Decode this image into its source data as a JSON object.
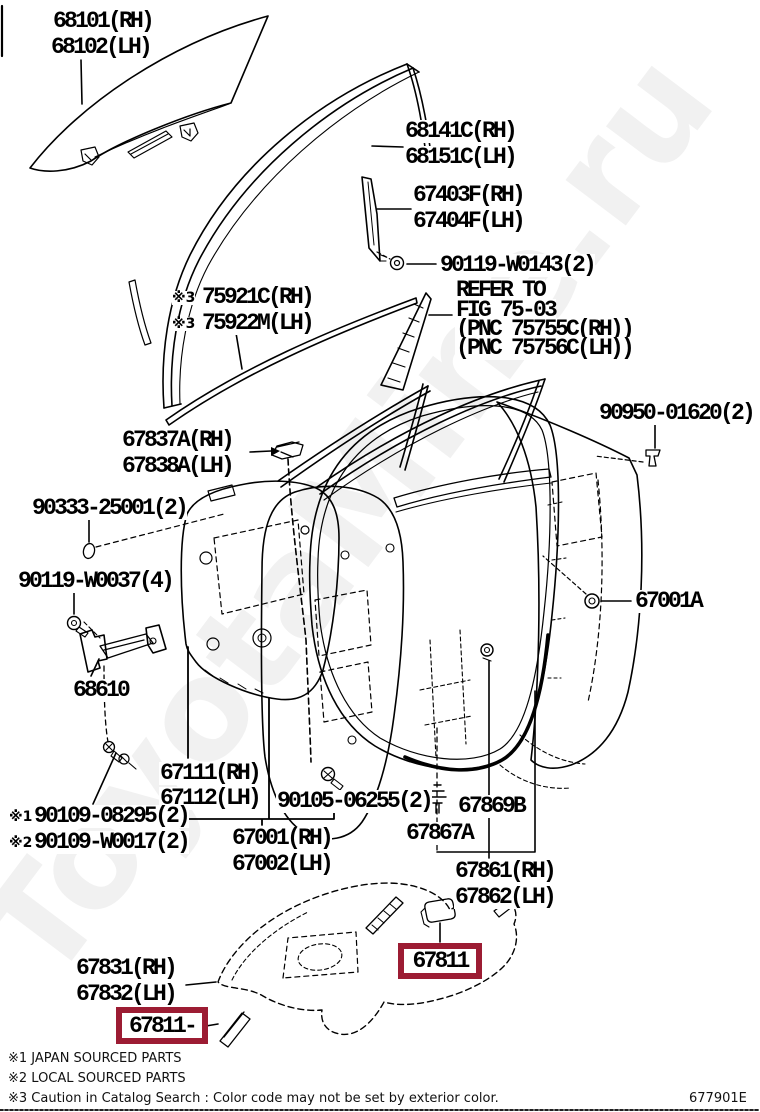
{
  "watermark": "ToyotaMine.ru",
  "colors": {
    "highlight_box": "#9C1C33",
    "line_art": "#000000",
    "watermark": "#F1F1F1",
    "background": "#FFFFFF"
  },
  "parts": {
    "door_glass": {
      "rh": "68101(RH)",
      "lh": "68102(LH)"
    },
    "glass_run": {
      "rh": "68141C(RH)",
      "lh": "68151C(LH)"
    },
    "front_sash": {
      "rh": "67403F(RH)",
      "lh": "67404F(LH)"
    },
    "sash_screw": "90119-W0143(2)",
    "refer_note": {
      "line1": "REFER TO",
      "line2": "FIG 75-03",
      "line3": "(PNC 75755C(RH))",
      "line4": "(PNC 75756C(LH))"
    },
    "blackout_tape": {
      "prefix": "※3",
      "rh": "75921C(RH)",
      "lh": "75922M(LH)"
    },
    "frame_clip": {
      "rh": "67837A(RH)",
      "lh": "67838A(LH)"
    },
    "grommet": "90950-01620(2)",
    "gasket": "90333-25001(2)",
    "check_bolt": "90119-W0037(4)",
    "panel_bolt": "67001A",
    "door_check": "68610",
    "inner_panel": {
      "rh": "67111(RH)",
      "lh": "67112(LH)"
    },
    "check_screws": {
      "prefix1": "※1",
      "no1": "90109-08295(2)",
      "prefix2": "※2",
      "no2": "90109-W0017(2)"
    },
    "panel_screw": "90105-06255(2)",
    "cushion": "67869B",
    "trim_clip": "67867A",
    "weatherstrip": {
      "rh": "67861(RH)",
      "lh": "67862(LH)"
    },
    "door_panel": {
      "rh": "67001(RH)",
      "lh": "67002(LH)"
    },
    "service_cover": {
      "rh": "67831(RH)",
      "lh": "67832(LH)"
    },
    "pad_highlight_right": "67811",
    "pad_highlight_left": "67811-"
  },
  "footer": {
    "note1": "※1 JAPAN SOURCED PARTS",
    "note2": "※2 LOCAL SOURCED PARTS",
    "note3": "※3 Caution in Catalog Search : Color code may not be set by exterior color.",
    "figure_code": "677901E"
  }
}
